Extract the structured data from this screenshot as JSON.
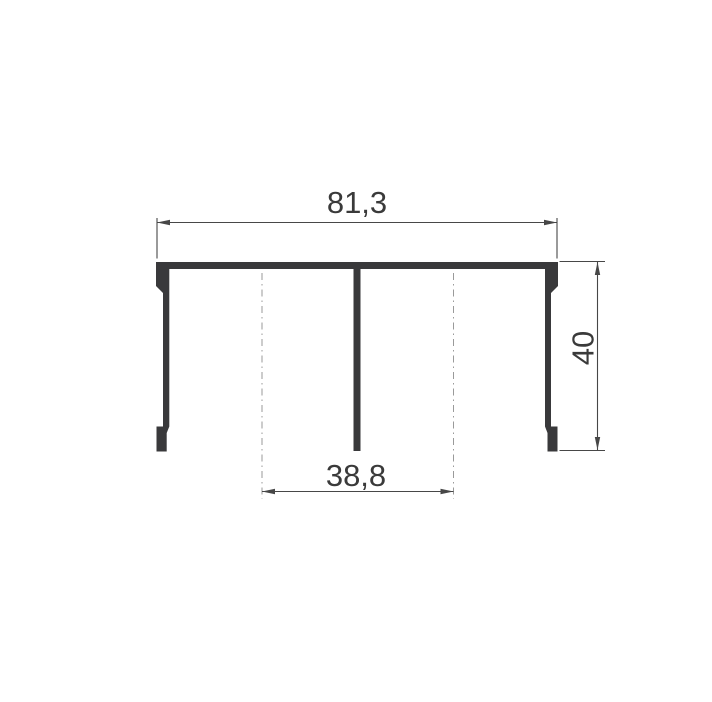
{
  "drawing": {
    "labels": {
      "overall_width": "81,3",
      "overall_height": "40",
      "center_spacing": "38,8"
    },
    "colors": {
      "background": "#ffffff",
      "profile": "#39393b",
      "dimension": "#474747",
      "centerline": "#9a9a9a",
      "text": "#3a3a3a"
    }
  }
}
